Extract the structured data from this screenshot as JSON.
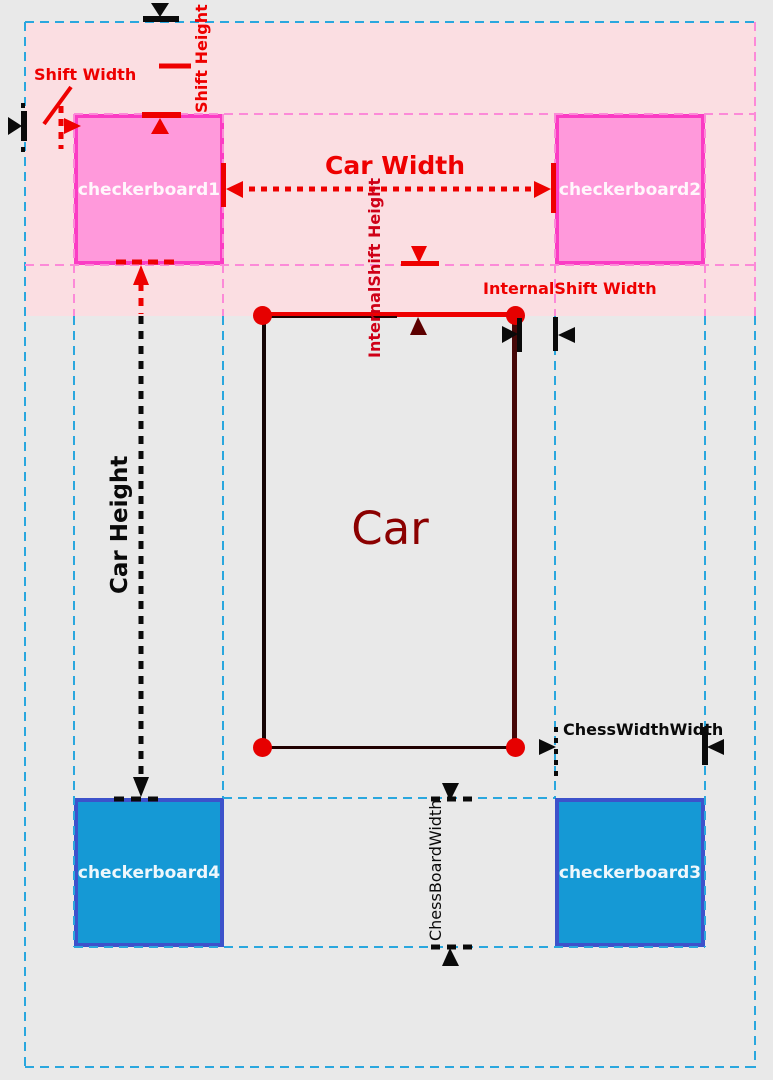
{
  "diagram": {
    "car": {
      "label": "Car"
    },
    "checkerboards": [
      {
        "label": "checkerboard1",
        "fill": "#FF99DB",
        "border": "#FB3CC4"
      },
      {
        "label": "checkerboard2",
        "fill": "#FF99DB",
        "border": "#FB3CC4"
      },
      {
        "label": "checkerboard3",
        "fill": "#1599D5",
        "border": "#3D52CB"
      },
      {
        "label": "checkerboard4",
        "fill": "#1599D5",
        "border": "#3D52CB"
      }
    ],
    "annotations": {
      "shift_width": "Shift Width",
      "shift_height": "Shift Height",
      "car_width": "Car Width",
      "car_height": "Car Height",
      "internalshift_height": "InternalShift Height",
      "internalshift_width": "InternalShift Width",
      "chesswidthwidth": "ChessWidthWidth",
      "chessboardwidth": "ChessBoardWidth"
    },
    "colors": {
      "background": "#E9E9E9",
      "pink_region": "#FBDEE2",
      "red_annotation": "#EE0000",
      "dark_red_label": "#8B0000",
      "maroon_arrow": "#5C0000",
      "black_annotation": "#0A0A0A",
      "cyan_dashed": "#2AA7DE",
      "pink_dashed": "#FC8AD8"
    }
  }
}
